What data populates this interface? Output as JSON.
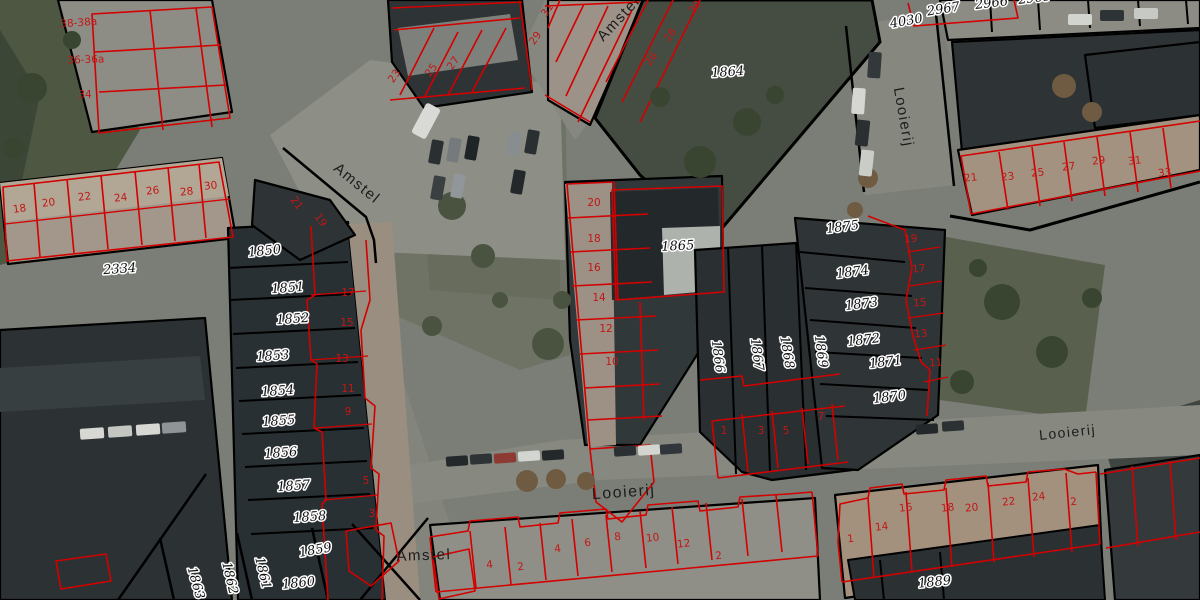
{
  "map": {
    "colors": {
      "cadastral_line_red": "#d40000",
      "boundary_black": "#000000",
      "parcel_label_text": "#101010",
      "house_number_text": "#c31616",
      "street_label_text": "#1c1c1c"
    },
    "street_labels": [
      {
        "text": "Amstel",
        "x": 622,
        "y": 22,
        "r": -47,
        "s": 15
      },
      {
        "text": "Amstel",
        "x": 354,
        "y": 187,
        "r": 39,
        "s": 15
      },
      {
        "text": "Amstel",
        "x": 424,
        "y": 560,
        "r": -2,
        "s": 15
      },
      {
        "text": "Looierij",
        "x": 899,
        "y": 118,
        "r": 80,
        "s": 15
      },
      {
        "text": "Looierij",
        "x": 624,
        "y": 497,
        "r": -4,
        "s": 16
      },
      {
        "text": "Looierij",
        "x": 1068,
        "y": 437,
        "r": -6,
        "s": 14
      }
    ],
    "parcel_labels": [
      {
        "text": "2334",
        "x": 120,
        "y": 273,
        "r": -4
      },
      {
        "text": "1850",
        "x": 265,
        "y": 255,
        "r": -6
      },
      {
        "text": "1851",
        "x": 288,
        "y": 292,
        "r": -4
      },
      {
        "text": "1852",
        "x": 293,
        "y": 323,
        "r": -4
      },
      {
        "text": "1853",
        "x": 273,
        "y": 360,
        "r": -4
      },
      {
        "text": "1854",
        "x": 278,
        "y": 395,
        "r": -4
      },
      {
        "text": "1855",
        "x": 279,
        "y": 425,
        "r": -4
      },
      {
        "text": "1856",
        "x": 281,
        "y": 457,
        "r": -4
      },
      {
        "text": "1857",
        "x": 294,
        "y": 490,
        "r": -4
      },
      {
        "text": "1858",
        "x": 310,
        "y": 521,
        "r": -4
      },
      {
        "text": "1859",
        "x": 316,
        "y": 554,
        "r": -10
      },
      {
        "text": "1860",
        "x": 299,
        "y": 587,
        "r": -6
      },
      {
        "text": "1861",
        "x": 259,
        "y": 574,
        "r": 77
      },
      {
        "text": "1862",
        "x": 226,
        "y": 579,
        "r": 77
      },
      {
        "text": "1863",
        "x": 192,
        "y": 584,
        "r": 74
      },
      {
        "text": "1864",
        "x": 728,
        "y": 76,
        "r": -4
      },
      {
        "text": "1865",
        "x": 678,
        "y": 250,
        "r": -3
      },
      {
        "text": "1866",
        "x": 714,
        "y": 357,
        "r": 82
      },
      {
        "text": "1867",
        "x": 753,
        "y": 355,
        "r": 82
      },
      {
        "text": "1868",
        "x": 783,
        "y": 353,
        "r": 80
      },
      {
        "text": "1869",
        "x": 817,
        "y": 352,
        "r": 82
      },
      {
        "text": "1870",
        "x": 890,
        "y": 401,
        "r": -7
      },
      {
        "text": "1871",
        "x": 886,
        "y": 366,
        "r": -7
      },
      {
        "text": "1872",
        "x": 864,
        "y": 344,
        "r": -7
      },
      {
        "text": "1873",
        "x": 862,
        "y": 308,
        "r": -7
      },
      {
        "text": "1874",
        "x": 853,
        "y": 276,
        "r": -7
      },
      {
        "text": "1875",
        "x": 843,
        "y": 231,
        "r": -7
      },
      {
        "text": "1889",
        "x": 935,
        "y": 586,
        "r": -6
      },
      {
        "text": "2967",
        "x": 944,
        "y": 13,
        "r": -9
      },
      {
        "text": "2966",
        "x": 992,
        "y": 7,
        "r": -7
      },
      {
        "text": "2965",
        "x": 1035,
        "y": 2,
        "r": -7
      },
      {
        "text": "4030",
        "x": 907,
        "y": 25,
        "r": -10
      }
    ],
    "house_numbers": [
      {
        "text": "38-38a",
        "x": 79,
        "y": 26,
        "r": -4,
        "s": 12
      },
      {
        "text": "36-36a",
        "x": 86,
        "y": 63,
        "r": -2,
        "s": 12
      },
      {
        "text": "34",
        "x": 85,
        "y": 98,
        "r": 0,
        "s": 12
      },
      {
        "text": "18",
        "x": 20,
        "y": 212,
        "r": -8
      },
      {
        "text": "20",
        "x": 49,
        "y": 206,
        "r": -8
      },
      {
        "text": "22",
        "x": 85,
        "y": 200,
        "r": -8
      },
      {
        "text": "24",
        "x": 121,
        "y": 201,
        "r": -6
      },
      {
        "text": "26",
        "x": 153,
        "y": 194,
        "r": -6
      },
      {
        "text": "28",
        "x": 187,
        "y": 195,
        "r": -6
      },
      {
        "text": "30",
        "x": 211,
        "y": 189,
        "r": -6
      },
      {
        "text": "21",
        "x": 294,
        "y": 205,
        "r": 55
      },
      {
        "text": "19",
        "x": 318,
        "y": 222,
        "r": 55
      },
      {
        "text": "23",
        "x": 397,
        "y": 78,
        "r": -55
      },
      {
        "text": "25",
        "x": 434,
        "y": 72,
        "r": -55
      },
      {
        "text": "27",
        "x": 456,
        "y": 65,
        "r": -55
      },
      {
        "text": "29",
        "x": 538,
        "y": 40,
        "r": -55
      },
      {
        "text": "31",
        "x": 550,
        "y": 12,
        "r": -55
      },
      {
        "text": "26",
        "x": 654,
        "y": 61,
        "r": -55
      },
      {
        "text": "28",
        "x": 673,
        "y": 37,
        "r": -55
      },
      {
        "text": "30",
        "x": 698,
        "y": 9,
        "r": -55
      },
      {
        "text": "17",
        "x": 348,
        "y": 296,
        "r": 0
      },
      {
        "text": "15",
        "x": 347,
        "y": 326,
        "r": 0
      },
      {
        "text": "13",
        "x": 342,
        "y": 362,
        "r": 0
      },
      {
        "text": "11",
        "x": 348,
        "y": 392,
        "r": 0
      },
      {
        "text": "9",
        "x": 348,
        "y": 415,
        "r": 0
      },
      {
        "text": "5",
        "x": 366,
        "y": 484,
        "r": 0
      },
      {
        "text": "3",
        "x": 372,
        "y": 517,
        "r": 0
      },
      {
        "text": "20",
        "x": 594,
        "y": 206,
        "r": 0
      },
      {
        "text": "18",
        "x": 594,
        "y": 242,
        "r": 0
      },
      {
        "text": "16",
        "x": 594,
        "y": 271,
        "r": 0
      },
      {
        "text": "14",
        "x": 599,
        "y": 301,
        "r": 0
      },
      {
        "text": "12",
        "x": 606,
        "y": 332,
        "r": 0
      },
      {
        "text": "10",
        "x": 612,
        "y": 365,
        "r": 0
      },
      {
        "text": "19",
        "x": 911,
        "y": 242,
        "r": -4
      },
      {
        "text": "17",
        "x": 919,
        "y": 272,
        "r": -4
      },
      {
        "text": "15",
        "x": 920,
        "y": 306,
        "r": -4
      },
      {
        "text": "13",
        "x": 921,
        "y": 337,
        "r": -4
      },
      {
        "text": "11",
        "x": 936,
        "y": 366,
        "r": -4
      },
      {
        "text": "21",
        "x": 971,
        "y": 181,
        "r": -6
      },
      {
        "text": "23",
        "x": 1008,
        "y": 180,
        "r": -6
      },
      {
        "text": "25",
        "x": 1038,
        "y": 176,
        "r": -6
      },
      {
        "text": "27",
        "x": 1069,
        "y": 170,
        "r": -6
      },
      {
        "text": "29",
        "x": 1099,
        "y": 164,
        "r": -6
      },
      {
        "text": "31",
        "x": 1135,
        "y": 164,
        "r": -6
      },
      {
        "text": "33",
        "x": 1165,
        "y": 176,
        "r": -6
      },
      {
        "text": "1",
        "x": 724,
        "y": 434,
        "r": 0
      },
      {
        "text": "3",
        "x": 761,
        "y": 434,
        "r": 0
      },
      {
        "text": "5",
        "x": 786,
        "y": 434,
        "r": 0
      },
      {
        "text": "7",
        "x": 821,
        "y": 420,
        "r": 0
      },
      {
        "text": "4",
        "x": 490,
        "y": 568,
        "r": -6
      },
      {
        "text": "2",
        "x": 521,
        "y": 570,
        "r": -6
      },
      {
        "text": "4",
        "x": 558,
        "y": 552,
        "r": -6
      },
      {
        "text": "6",
        "x": 588,
        "y": 546,
        "r": -6
      },
      {
        "text": "8",
        "x": 618,
        "y": 540,
        "r": -6
      },
      {
        "text": "10",
        "x": 653,
        "y": 541,
        "r": -6
      },
      {
        "text": "12",
        "x": 684,
        "y": 547,
        "r": -6
      },
      {
        "text": "2",
        "x": 719,
        "y": 559,
        "r": -6
      },
      {
        "text": "1",
        "x": 851,
        "y": 542,
        "r": -6
      },
      {
        "text": "14",
        "x": 882,
        "y": 530,
        "r": -6
      },
      {
        "text": "16",
        "x": 906,
        "y": 511,
        "r": -6
      },
      {
        "text": "18",
        "x": 948,
        "y": 511,
        "r": -6
      },
      {
        "text": "20",
        "x": 972,
        "y": 511,
        "r": -6
      },
      {
        "text": "22",
        "x": 1009,
        "y": 505,
        "r": -6
      },
      {
        "text": "24",
        "x": 1039,
        "y": 500,
        "r": -6
      },
      {
        "text": "2",
        "x": 1074,
        "y": 505,
        "r": -6
      }
    ]
  }
}
